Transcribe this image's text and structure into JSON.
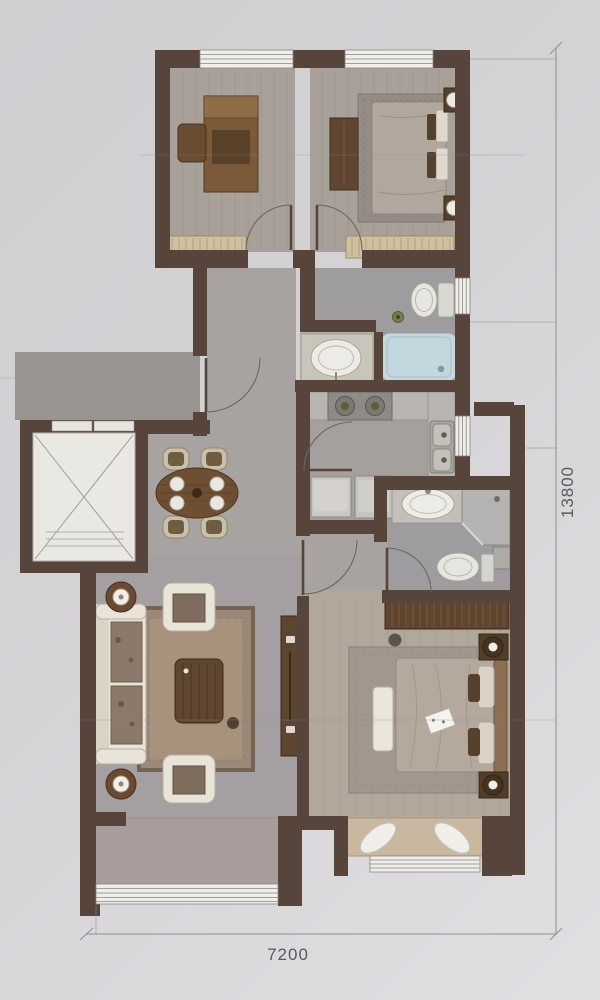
{
  "title": "apartment-floor-plan",
  "dimensions": {
    "width": "7200",
    "height": "13800"
  },
  "palette": {
    "paper": "#d4d3d6",
    "wall": "#57443a",
    "window": "#efeeeb",
    "wood_floor": "#a8a19a",
    "tile_floor": "#9e9c9f",
    "hall_floor": "#a7a3a1",
    "living_floor": "#a4a0a2",
    "master_floor": "#b1a79a",
    "balcony_floor": "#a99d9c",
    "bathtub": "#c3d7de",
    "furniture_dark_wood": "#5e4530",
    "sofa_cream": "#e8e4d8",
    "dining_table": "#6f4f33",
    "burner_green": "#55612f"
  },
  "rooms": [
    {
      "name": "study",
      "fixtures": [
        "desk",
        "chair",
        "low-cabinet"
      ]
    },
    {
      "name": "secondary-bedroom",
      "fixtures": [
        "bed",
        "rug",
        "nightstand-lamps",
        "dresser",
        "low-cabinet"
      ]
    },
    {
      "name": "main-bathroom",
      "fixtures": [
        "toilet",
        "bathtub",
        "vanity-basin",
        "plant"
      ]
    },
    {
      "name": "kitchen",
      "fixtures": [
        "cooktop",
        "double-sink",
        "counter",
        "appliances"
      ]
    },
    {
      "name": "master-bathroom",
      "fixtures": [
        "vanity-basin",
        "corner-shower",
        "toilet",
        "cabinet"
      ]
    },
    {
      "name": "hallway-dining",
      "fixtures": [
        "dining-table",
        "four-chairs",
        "entry-door"
      ]
    },
    {
      "name": "living-room",
      "fixtures": [
        "sofa",
        "armchairs",
        "coffee-table",
        "rug",
        "tv-cabinet",
        "floor-lamps"
      ]
    },
    {
      "name": "master-bedroom",
      "fixtures": [
        "double-bed",
        "wardrobe",
        "nightstand-lamps",
        "bench",
        "rug",
        "bay-window-cushions"
      ]
    },
    {
      "name": "balcony",
      "fixtures": []
    },
    {
      "name": "elevator",
      "fixtures": [
        "elevator-cab"
      ]
    }
  ]
}
